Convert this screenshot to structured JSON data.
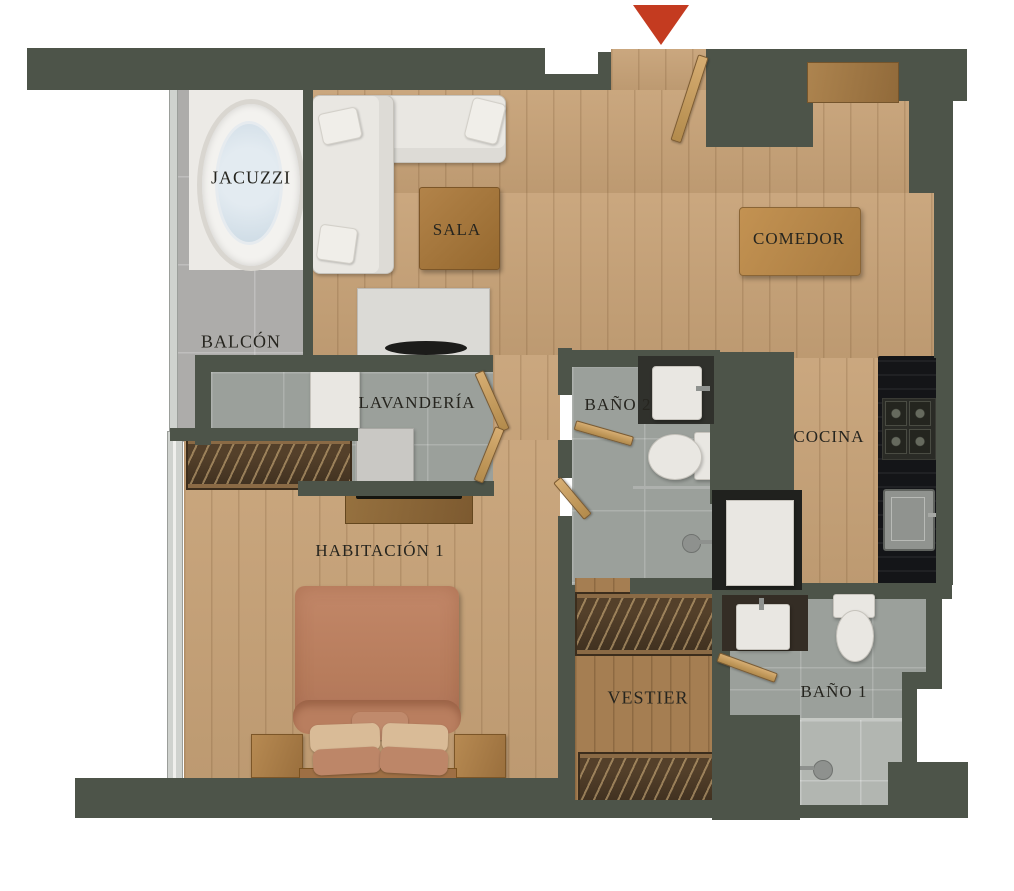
{
  "plan": {
    "type": "apartment-floor-plan",
    "entrance": {
      "marker": "red-arrow",
      "color": "#c43b20"
    },
    "colors": {
      "wall": "#4d5449",
      "wood_floor": "#c7a277",
      "dark_wood_floor": "#a57e52",
      "balcony_tile": "#adacaa",
      "bath_tile": "#9ba09b",
      "kitchen_counter": "#151619",
      "bed": "#bd8264",
      "sofa": "#e9e7e2",
      "dining_table": "#b98b52"
    }
  },
  "rooms": {
    "jacuzzi": {
      "label": "JACUZZI"
    },
    "balcon": {
      "label": "BALCÓN"
    },
    "sala": {
      "label": "SALA"
    },
    "comedor": {
      "label": "COMEDOR"
    },
    "lavanderia": {
      "label": "LAVANDERÍA"
    },
    "bano2": {
      "label": "BAÑO 2"
    },
    "cocina": {
      "label": "COCINA"
    },
    "habitacion1": {
      "label": "HABITACIÓN 1"
    },
    "vestier": {
      "label": "VESTIER"
    },
    "bano1": {
      "label": "BAÑO 1"
    }
  }
}
